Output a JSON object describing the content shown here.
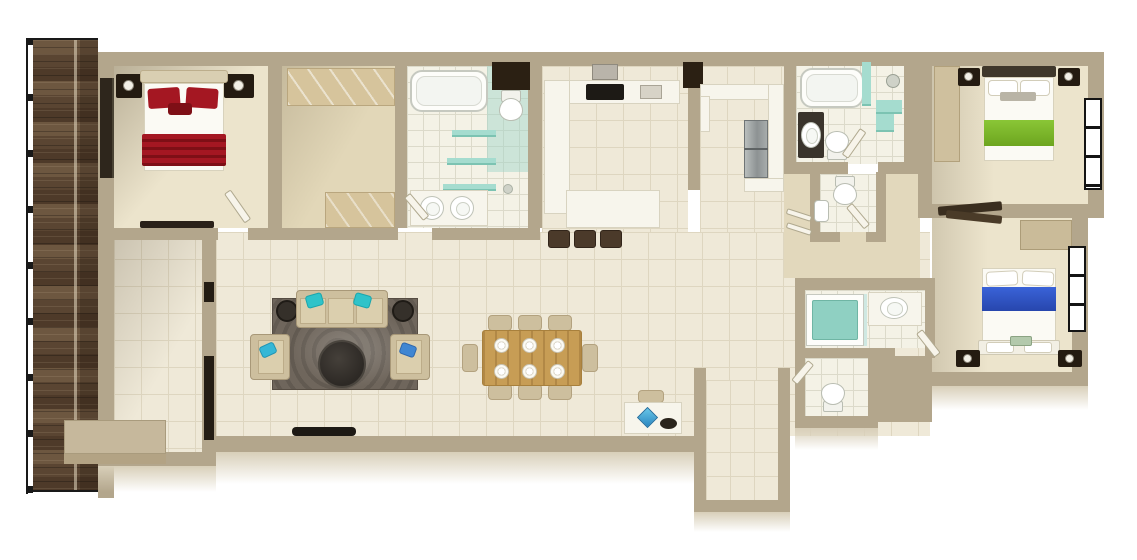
{
  "scene": {
    "type": "3d-floor-plan-top-down-render",
    "subject": "Three-bedroom apartment floor plan with balcony deck",
    "background": "#ffffff",
    "visible_text": []
  },
  "palette": {
    "wall": "#b3a68c",
    "wallFace": "#d8cfb9",
    "floorTile": "#efe9d8",
    "tileLine": "#ded6c0",
    "bathTile": "#f4f2e6",
    "bathLine": "#dcdaca",
    "carpet": "#ece4cc",
    "carpetTan": "#e2d7b8",
    "hallFloor": "#e2d8bc",
    "counter": "#f7f5ec",
    "counterEdge": "#d8d3c0",
    "niche": "#2b2013",
    "nightstand": "#241b11",
    "lamp": "#f2efe6",
    "deckBase": "#5f4a35",
    "railing": "#191919",
    "rug": "#6f665c",
    "wood": "#c79d55",
    "stool": "#4b3a2a",
    "tealCushion": "#2fc3c9",
    "blueCushion": "#3f86d2",
    "sofa": "#cdbf9e",
    "sofaSeat": "#dbcfae",
    "sofaTrim": "#a89878",
    "redA": "#a41722",
    "redB": "#7e0f16",
    "green": "#6da51f",
    "blue": "#2746ad",
    "glassTeal": "rgba(156,210,200,0.45)",
    "doorDark": "#3a2e1f",
    "windowFrame": "#141414",
    "tableDark": "#36322d",
    "tv": "#1d1914"
  },
  "building": {
    "rooms": [
      {
        "id": "balcony-deck",
        "label": "Balcony deck",
        "features": [
          "wood-plank-flooring",
          "black-metal-railing"
        ]
      },
      {
        "id": "master-bedroom",
        "label": "Master bedroom",
        "furniture": [
          "double-bed-red-bedding",
          "nightstand x2",
          "table-lamp x2",
          "low-dresser",
          "sliding-glass-door-to-deck",
          "door"
        ]
      },
      {
        "id": "walk-in-closet",
        "label": "Walk-in closet",
        "furniture": [
          "wardrobe-run-top",
          "wardrobe-bottom"
        ]
      },
      {
        "id": "master-bathroom",
        "label": "Master bathroom",
        "furniture": [
          "bathtub",
          "toilet",
          "glass-shower-zone",
          "glass-shelves x3",
          "double-sink-vanity",
          "door"
        ]
      },
      {
        "id": "kitchen",
        "label": "Kitchen",
        "furniture": [
          "l-shaped-counter",
          "cooktop",
          "range-hood",
          "sink",
          "breakfast-island",
          "bar-stool x3",
          "wall-niche x2"
        ]
      },
      {
        "id": "utility-pantry",
        "label": "Utility / pantry",
        "furniture": [
          "u-shaped-counter",
          "stainless-steel-appliance"
        ]
      },
      {
        "id": "living-room",
        "label": "Living room",
        "furniture": [
          "three-seat-sofa",
          "armchair x2",
          "teal-cushion x3",
          "blue-cushion x1",
          "round-coffee-table",
          "round-side-table x2",
          "area-rug",
          "tv-console"
        ]
      },
      {
        "id": "dining-area",
        "label": "Dining area",
        "furniture": [
          "wood-dining-table",
          "dining-chair x8",
          "place-setting x6"
        ]
      },
      {
        "id": "workspace",
        "label": "Work corner",
        "furniture": [
          "white-desk",
          "chair",
          "blue-ornament",
          "dark-bowl"
        ]
      },
      {
        "id": "foyer",
        "label": "Foyer",
        "furniture": [
          "bench-platform",
          "dark-sliding-partition"
        ]
      },
      {
        "id": "entry-vestibule",
        "label": "Entry vestibule",
        "furniture": []
      },
      {
        "id": "bathroom-2",
        "label": "Bathroom 2",
        "furniture": [
          "bathtub",
          "dark-vanity-with-sink",
          "toilet",
          "shower-head",
          "teal-corner-shelf",
          "door"
        ]
      },
      {
        "id": "wc-1",
        "label": "WC 1",
        "furniture": [
          "toilet",
          "hand-basin",
          "door"
        ]
      },
      {
        "id": "hallway",
        "label": "Hallway",
        "furniture": [
          "linen-shelves",
          "open-door-leaf x2"
        ]
      },
      {
        "id": "shower-room",
        "label": "Shower room",
        "furniture": [
          "shower-tray-teal-mat",
          "vanity-sink",
          "glass-screen",
          "door"
        ]
      },
      {
        "id": "wc-2",
        "label": "WC 2",
        "furniture": [
          "toilet"
        ]
      },
      {
        "id": "bedroom-green",
        "label": "Bedroom 2 (green bedding)",
        "furniture": [
          "double-bed-green-bedding",
          "nightstand x2",
          "tall-wardrobe",
          "window-double"
        ]
      },
      {
        "id": "bedroom-blue",
        "label": "Bedroom 3 (blue bedding)",
        "furniture": [
          "double-bed-blue-bedding",
          "nightstand x2",
          "wardrobe",
          "window"
        ]
      }
    ]
  }
}
